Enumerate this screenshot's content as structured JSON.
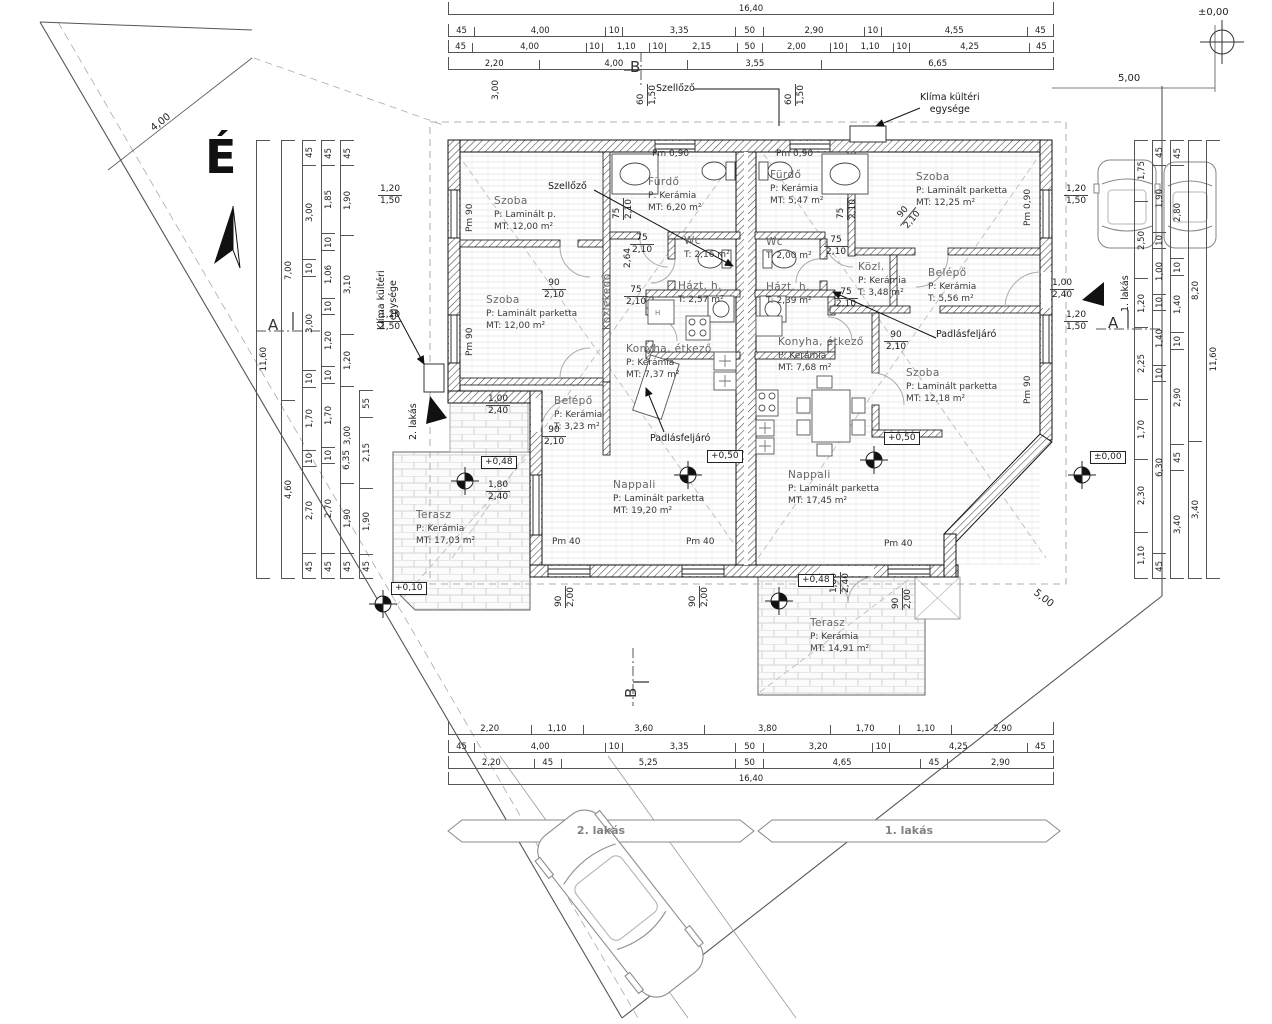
{
  "compass": {
    "north": "É"
  },
  "site": {
    "banner_left": "2. lakás",
    "banner_right": "1. lakás",
    "dim_boundary_topleft": "4,00",
    "dim_top_right": "5,00",
    "dim_boundary_bottomright": "5,00",
    "benchmark_elev": "±0,00"
  },
  "sections": {
    "a": "A",
    "b": "B"
  },
  "annotations": {
    "szellozo_top": "Szellőző",
    "szellozo_left": "Szellőző",
    "klima_line1": "Klíma kültéri",
    "klima_line2": "egysége",
    "klima_left_line1": "Klíma kültéri",
    "klima_left_line2": "egysége",
    "padlas_left": "Padlásfeljáró",
    "padlas_right": "Padlásfeljáró",
    "lakas2_arrow": "2. lakás",
    "lakas1_arrow": "1. lakás"
  },
  "elevations": {
    "nappali_left": "+0,50",
    "nappali_right": "+0,50",
    "terasz_left": "+0,48",
    "terasz_right": "+0,48",
    "ground_left": "+0,10",
    "ground_right": "±0,00"
  },
  "pm": {
    "pm090": "Pm 0,90",
    "pm90": "Pm 90",
    "pm40": "Pm 40"
  },
  "apt2": {
    "name": "2. lakás",
    "rooms": [
      {
        "name": "Szoba",
        "l1": "P: Laminált p.",
        "l2": "MT: 12,00 m²"
      },
      {
        "name": "Szoba",
        "l1": "P: Laminált parketta",
        "l2": "MT: 12,00 m²"
      },
      {
        "name": "Fürdő",
        "l1": "P: Kerámia",
        "l2": "MT: 6,20 m²"
      },
      {
        "name": "Wc",
        "l1": "T: 2,16 m²",
        "l2": ""
      },
      {
        "name": "Közlekedő",
        "l1": "",
        "l2": ""
      },
      {
        "name": "Házt. h.",
        "l1": "T: 2,57 m²",
        "l2": ""
      },
      {
        "name": "Konyha, étkező",
        "l1": "P: Kerámia",
        "l2": "MT: 7,37 m²"
      },
      {
        "name": "Belépő",
        "l1": "P: Kerámia",
        "l2": "T: 3,23 m²"
      },
      {
        "name": "Nappali",
        "l1": "P: Laminált parketta",
        "l2": "MT: 19,20 m²"
      },
      {
        "name": "Terasz",
        "l1": "P: Kerámia",
        "l2": "MT: 17,03 m²"
      }
    ]
  },
  "apt1": {
    "name": "1. lakás",
    "rooms": [
      {
        "name": "Fürdő",
        "l1": "P: Kerámia",
        "l2": "MT: 5,47 m²"
      },
      {
        "name": "Wc",
        "l1": "T: 2,00 m²",
        "l2": ""
      },
      {
        "name": "Házt. h.",
        "l1": "T: 2,39 m²",
        "l2": ""
      },
      {
        "name": "Szoba",
        "l1": "P: Laminált parketta",
        "l2": "MT: 12,25 m²"
      },
      {
        "name": "Közl.",
        "l1": "P: Kerámia",
        "l2": "T: 3,48 m²"
      },
      {
        "name": "Belépő",
        "l1": "P: Kerámia",
        "l2": "T: 5,56 m²"
      },
      {
        "name": "Konyha, étkező",
        "l1": "P: Kerámia",
        "l2": "MT: 7,68 m²"
      },
      {
        "name": "Szoba",
        "l1": "P: Laminált parketta",
        "l2": "MT: 12,18 m²"
      },
      {
        "name": "Nappali",
        "l1": "P: Laminált parketta",
        "l2": "MT: 17,45 m²"
      },
      {
        "name": "Terasz",
        "l1": "P: Kerámia",
        "l2": "MT: 14,91 m²"
      }
    ]
  },
  "dims": {
    "top": {
      "overall": [
        "16,40"
      ],
      "row2": [
        "45",
        "4,00",
        "10",
        "3,35",
        "50",
        "2,90",
        "10",
        "4,55",
        "45"
      ],
      "row3": [
        "45",
        "4,00",
        "10",
        "1,10",
        "10",
        "2,15",
        "50",
        "2,00",
        "10",
        "1,10",
        "10",
        "4,25",
        "45"
      ],
      "row4": [
        "2,20",
        "4,00",
        "3,55",
        "6,65"
      ]
    },
    "bottom": {
      "row1": [
        "2,20",
        "1,10",
        "3,60",
        "3,80",
        "1,70",
        "1,10",
        "2,90"
      ],
      "row2": [
        "45",
        "4,00",
        "10",
        "3,35",
        "50",
        "3,20",
        "10",
        "4,25",
        "45"
      ],
      "row3": [
        "2,20",
        "45",
        "5,25",
        "50",
        "4,65",
        "45",
        "2,90"
      ],
      "overall": [
        "16,40"
      ]
    },
    "left": {
      "overall": [
        "11,60"
      ],
      "c2": [
        "7,00",
        "4,60"
      ],
      "c3": [
        "45",
        "3,00",
        "10",
        "3,00",
        "10",
        "1,70",
        "10",
        "2,70",
        "45"
      ],
      "c4": [
        "45",
        "1,85",
        "10",
        "1,06",
        "10",
        "1,20",
        "10",
        "1,70",
        "10",
        "2,70",
        "45"
      ],
      "c5": [
        "45",
        "1,90",
        "3,10",
        "1,20",
        "3,00",
        "1,90",
        "45"
      ],
      "c6": [
        "55",
        "2,15",
        "1,90",
        "45"
      ]
    },
    "right": {
      "overall": [
        "11,60"
      ],
      "c4": [
        "8,20",
        "3,40"
      ],
      "c3": [
        "45",
        "2,80",
        "10",
        "1,40",
        "10",
        "2,90",
        "45",
        "3,40"
      ],
      "c2": [
        "45",
        "1,90",
        "10",
        "1,00",
        "10",
        "1,40",
        "10",
        "6,30",
        "45"
      ],
      "c1": [
        "1,75",
        "2,50",
        "1,20",
        "2,25",
        "1,70",
        "2,30",
        "1,10"
      ]
    },
    "misc": {
      "k264": "2,64",
      "d635": "6,35",
      "v300": "3,00"
    },
    "openings": [
      {
        "a": "1,20",
        "b": "1,50"
      },
      {
        "a": "1,20",
        "b": "1,50"
      },
      {
        "a": "1,00",
        "b": "2,40"
      },
      {
        "a": "1,80",
        "b": "2,40"
      },
      {
        "a": "90",
        "b": "2,10"
      },
      {
        "a": "90",
        "b": "2,10"
      },
      {
        "a": "75",
        "b": "2,10"
      },
      {
        "a": "75",
        "b": "2,10"
      },
      {
        "a": "75",
        "b": "2,10"
      },
      {
        "a": "60",
        "b": "1,50"
      },
      {
        "a": "60",
        "b": "1,50"
      },
      {
        "a": "75",
        "b": "2,10"
      },
      {
        "a": "75",
        "b": "2,10"
      },
      {
        "a": "75",
        "b": "2,10"
      },
      {
        "a": "90",
        "b": "2,10"
      },
      {
        "a": "90",
        "b": "2,10"
      },
      {
        "a": "1,20",
        "b": "1,50"
      },
      {
        "a": "1,20",
        "b": "1,50"
      },
      {
        "a": "1,00",
        "b": "2,40"
      },
      {
        "a": "90",
        "b": "2,00"
      },
      {
        "a": "90",
        "b": "2,00"
      },
      {
        "a": "90",
        "b": "2,00"
      },
      {
        "a": "1,80",
        "b": "2,40"
      }
    ]
  }
}
